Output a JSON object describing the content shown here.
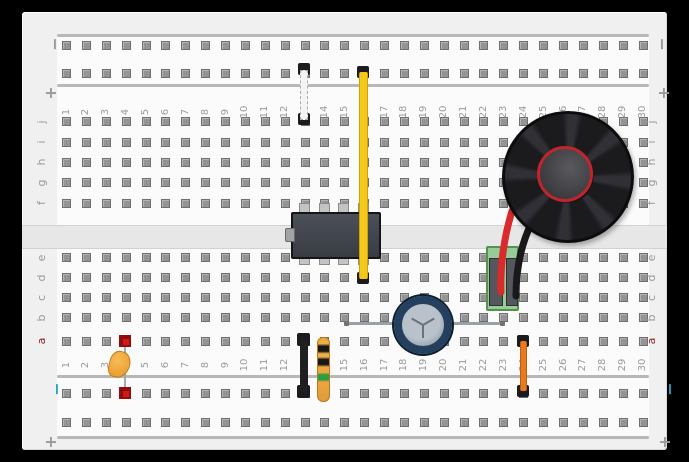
{
  "board": {
    "description": "solderless breadboard circuit diagram",
    "column_numbers": [
      1,
      2,
      3,
      4,
      5,
      6,
      7,
      8,
      9,
      10,
      11,
      12,
      13,
      14,
      15,
      16,
      17,
      18,
      19,
      20,
      21,
      22,
      23,
      24,
      25,
      26,
      27,
      28,
      29,
      30
    ],
    "row_letters_upper": [
      "j",
      "i",
      "h",
      "g",
      "f"
    ],
    "row_letters_lower": [
      "e",
      "d",
      "c",
      "b",
      "a"
    ],
    "rail_markers": {
      "minus": "−",
      "plus": "+"
    },
    "label_color": "#9a9a9a",
    "row_a_label_color": "#8b2121",
    "bottom_minus_color": "#2aa3c0",
    "frame_color": "#000000",
    "board_color": "#f0f0f0"
  },
  "components": [
    {
      "name": "jumper-wire-white",
      "type": "jumper wire",
      "color": "#f4f4f4",
      "from": "top rail row 2, col 13",
      "to": "row j, col 13"
    },
    {
      "name": "jumper-wire-yellow",
      "type": "jumper wire",
      "color": "#f4c81b",
      "from": "top rail row 2, col 16",
      "to": "row d, col 16"
    },
    {
      "name": "ic-chip",
      "type": "8-pin DIP IC",
      "color": "#42464d",
      "pins": "cols 13-16, rows f and e, straddling center channel"
    },
    {
      "name": "speaker",
      "type": "round speaker",
      "color": "#1b1b1e",
      "accent_ring_color": "#c3242c",
      "position": "cols 23-29, upper half"
    },
    {
      "name": "terminal-block",
      "type": "2-pin screw terminal",
      "color": "#97cb97",
      "position": "cols 22-23, rows e-c"
    },
    {
      "name": "speaker-wire-red",
      "type": "hookup wire",
      "color": "#d92b2b",
      "from": "terminal block left slot",
      "to": "speaker"
    },
    {
      "name": "speaker-wire-black",
      "type": "hookup wire",
      "color": "#19191b",
      "from": "terminal block right slot",
      "to": "speaker"
    },
    {
      "name": "electrolytic-capacitor",
      "type": "capacitor (top view)",
      "ring_color": "#24405e",
      "leads": "row b, cols 15 to 23"
    },
    {
      "name": "ceramic-capacitor",
      "type": "capacitor",
      "color": "#eda43c",
      "from": "row a, col 4",
      "to": "bottom rail minus row, col 4",
      "highlighted_hole_color": "#d41717"
    },
    {
      "name": "jumper-wire-black",
      "type": "jumper wire",
      "color": "#202022",
      "from": "row a, col 13",
      "to": "bottom rail minus row, col 13"
    },
    {
      "name": "resistor",
      "type": "resistor",
      "body_color": "#eda53f",
      "bands": [
        "black",
        "black",
        "green"
      ],
      "from": "row a, col 14",
      "to": "bottom rail minus row, col 14"
    },
    {
      "name": "jumper-wire-orange",
      "type": "jumper wire",
      "color": "#e87a20",
      "from": "row a, col 24",
      "to": "bottom rail minus row, col 24"
    }
  ]
}
